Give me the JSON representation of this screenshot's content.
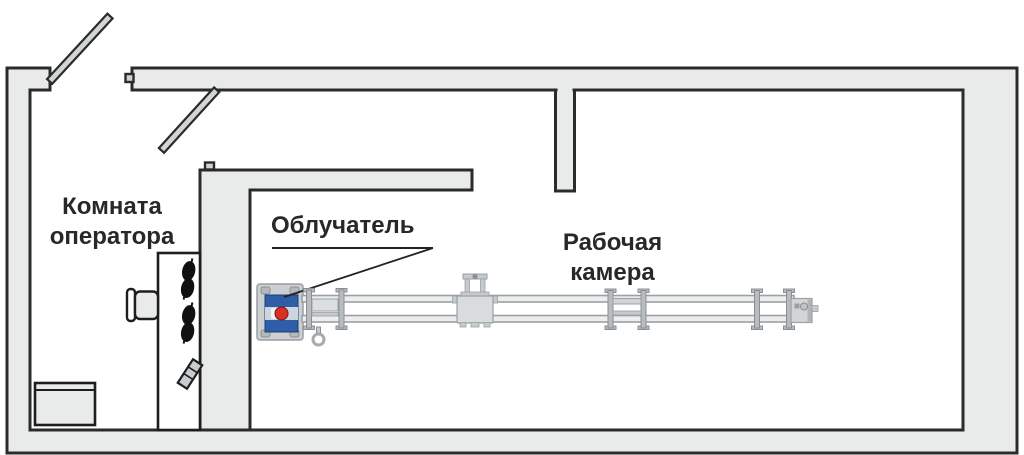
{
  "labels": {
    "operator_room": "Комната\nоператора",
    "irradiator": "Облучатель",
    "working_chamber": "Рабочая\nкамера"
  },
  "colors": {
    "background": "#ffffff",
    "wall_fill": "#e9ebeb",
    "wall_outline": "#2b2b2b",
    "equipment_gray": "#d2d5d7",
    "equipment_edge": "#9aa0a4",
    "irradiator_blue": "#2e5ea8",
    "source_red": "#d83025"
  },
  "icons": {
    "door_leaf_outer": "door-leaf-icon",
    "door_leaf_inner": "door-leaf-icon",
    "control_desk": "control-desk-icon",
    "operator_chair": "chair-icon",
    "cabinet": "cabinet-icon",
    "headset_blobs": "headset-icon",
    "keyboard_tile": "keyboard-icon",
    "irradiator_head": "irradiator-icon",
    "source_dot": "radiation-source-icon",
    "conveyor": "conveyor-line-icon",
    "hook": "hook-icon"
  }
}
